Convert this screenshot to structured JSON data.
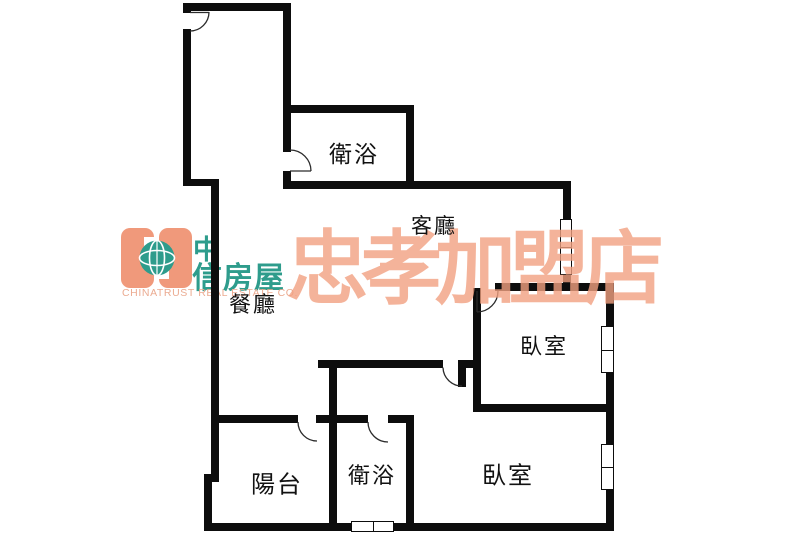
{
  "colors": {
    "wall": "#0D0D0D",
    "arc": "#2B2B2B",
    "salmon": "#F0997B",
    "teal": "#2E9C8C",
    "salmon_text": "#EBAB91",
    "watermark": "#F2A181",
    "label": "#111111"
  },
  "watermark": {
    "text": "忠孝加盟店"
  },
  "logo": {
    "cn_line1": "中",
    "cn_line2": "信房屋",
    "en": "CHINATRUST REAL ESTATE CO."
  },
  "rooms": {
    "bath_top": {
      "label": "衛浴"
    },
    "living": {
      "label": "客廳"
    },
    "dining": {
      "label": "餐廳"
    },
    "bedroom_upper": {
      "label": "臥室"
    },
    "bedroom_lower": {
      "label": "臥室"
    },
    "balcony": {
      "label": "陽台"
    },
    "bath_lower": {
      "label": "衛浴"
    }
  }
}
